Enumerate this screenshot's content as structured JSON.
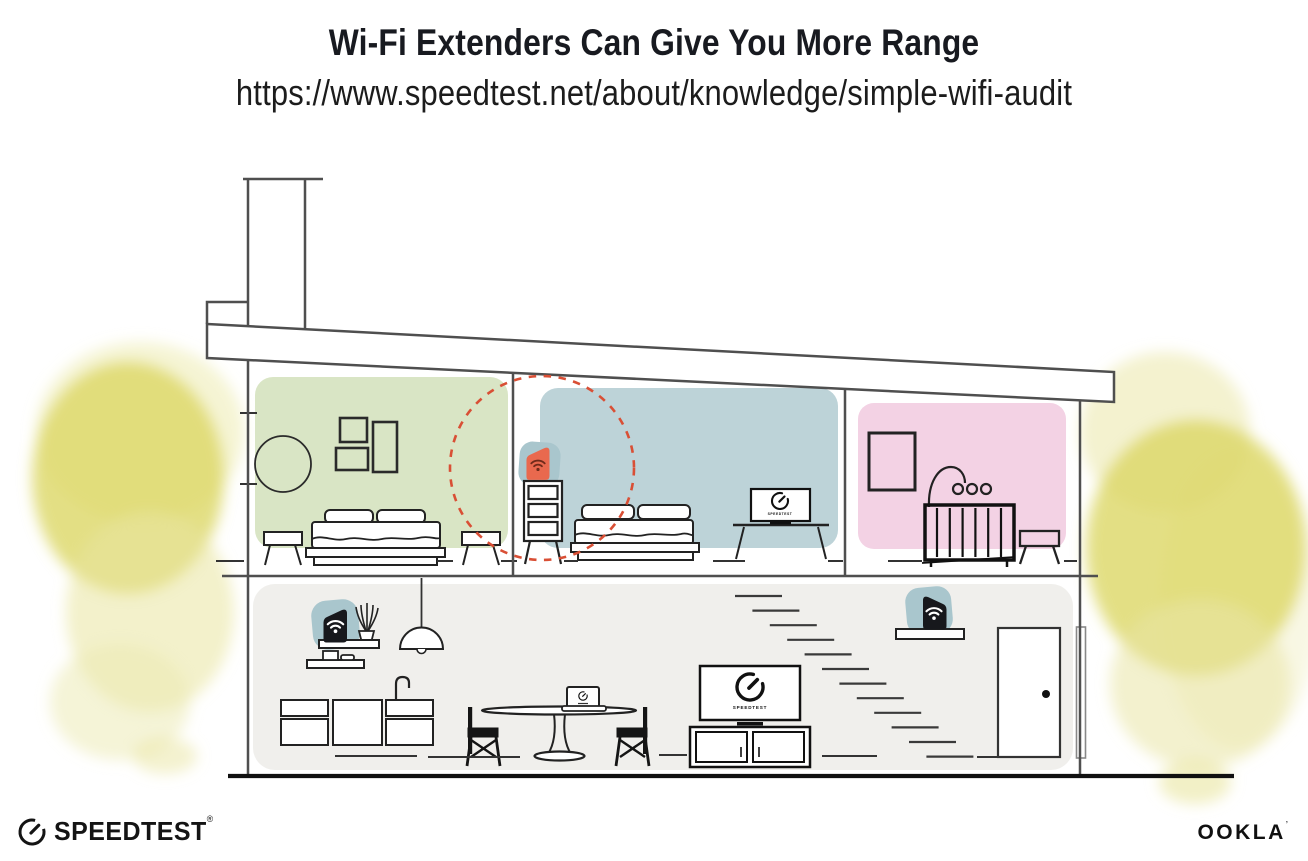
{
  "header": {
    "title": "Wi-Fi Extenders Can Give You More Range",
    "url": "https://www.speedtest.net/about/knowledge/simple-wifi-audit"
  },
  "labels": {
    "tv_screen": "SPEEDTEST"
  },
  "footer": {
    "speedtest_label": "SPEEDTEST",
    "speedtest_mark": "®",
    "ookla_label": "OOKLA",
    "ookla_mark": "’"
  },
  "palette": {
    "room_green": "#d9e5c5",
    "room_blue": "#bdd3d8",
    "room_pink": "#f3d2e4",
    "floor_gray": "#f0efec",
    "device_dark": "#17181c",
    "device_orange": "#e9694e",
    "device_blob": "#a9c6cd",
    "range_red": "#d94f35",
    "foliage_core": "#dcd765",
    "foliage_light": "#e9e6a0",
    "wall_line": "#4f4f4f",
    "ink": "#1b1c21"
  },
  "scene": {
    "description": "cutaway house showing wi-fi coverage",
    "highlight": {
      "name": "extender-range-circle",
      "style": "dashed",
      "color": "#d94f35"
    },
    "floors": [
      {
        "name": "upper-floor",
        "rooms": [
          {
            "name": "bedroom-left",
            "wall_color": "#d9e5c5",
            "furniture": [
              "round-mirror",
              "wall-frames",
              "double-bed",
              "nightstand-left",
              "nightstand-right"
            ]
          },
          {
            "name": "bedroom-middle",
            "wall_color": "#bdd3d8",
            "furniture": [
              "dresser",
              "double-bed",
              "tv-console"
            ],
            "devices": [
              "wifi-extender-highlighted"
            ]
          },
          {
            "name": "nursery",
            "wall_color": "#f3d2e4",
            "furniture": [
              "wall-frame",
              "baby-mobile",
              "crib",
              "stool"
            ]
          }
        ]
      },
      {
        "name": "ground-floor",
        "wall_color": "#f0efec",
        "furniture": [
          "wall-shelves",
          "plant",
          "pendant-lamp",
          "kitchen-cabinets",
          "faucet",
          "dining-table",
          "chair-left",
          "chair-right",
          "laptop",
          "tv",
          "media-console",
          "staircase",
          "door"
        ],
        "devices": [
          "wifi-router",
          "wifi-extender"
        ]
      }
    ]
  }
}
